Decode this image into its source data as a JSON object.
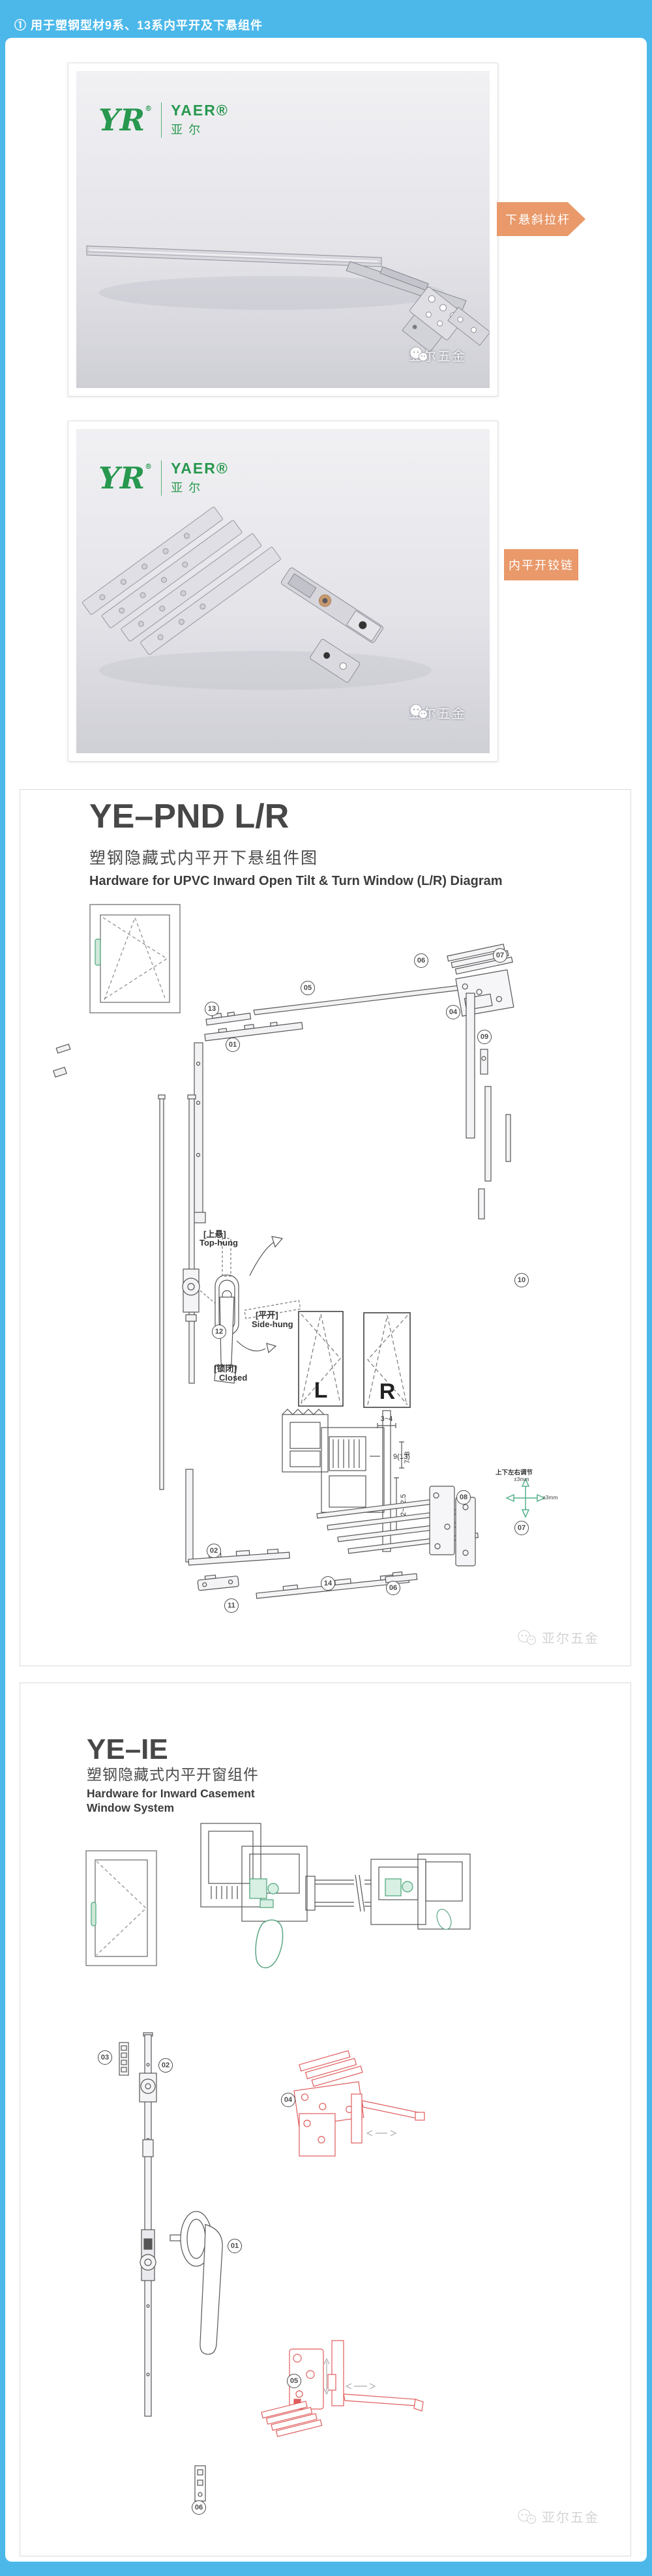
{
  "page": {
    "background": "#4cb8ea"
  },
  "header": {
    "text": "① 用于塑钢型材9系、13系内平开及下悬组件"
  },
  "brand": {
    "mark": "YR",
    "reg": "®",
    "name_en": "YAER®",
    "name_cn": "亚尔"
  },
  "watermark": {
    "text": "亚尔五金"
  },
  "photo_cards": [
    {
      "label": "下悬斜拉杆"
    },
    {
      "label": "内平开铰链"
    }
  ],
  "pnd": {
    "title": "YE–PND L/R",
    "subtitle_cn": "塑钢隐藏式内平开下悬组件图",
    "subtitle_en": "Hardware for UPVC  Inward Open Tilt & Turn Window (L/R) Diagram",
    "handle": {
      "tilt_cn": "[上悬]",
      "tilt_en": "Top-hung",
      "turn_cn": "[平开]",
      "turn_en": "Side-hung",
      "closed_cn": "[锁闭]",
      "closed_en": "Closed"
    },
    "lr": {
      "left": "L",
      "right": "R"
    },
    "dims": {
      "d1": "3~4",
      "d2": "9(13)",
      "d3": "7~8",
      "d4": "12~12.5"
    },
    "adjust": {
      "caption": "上下左右调节",
      "v": "±3mm",
      "h": "±3mm"
    },
    "markers": [
      "13",
      "01",
      "05",
      "06",
      "07",
      "04",
      "09",
      "10",
      "12",
      "02",
      "11",
      "14",
      "06",
      "08",
      "07"
    ]
  },
  "ie": {
    "title": "YE–IE",
    "subtitle_cn": "塑钢隐藏式内平开窗组件",
    "subtitle_en1": "Hardware for Inward Casement",
    "subtitle_en2": "Window System",
    "markers": [
      "03",
      "02",
      "04",
      "01",
      "05",
      "06"
    ]
  }
}
